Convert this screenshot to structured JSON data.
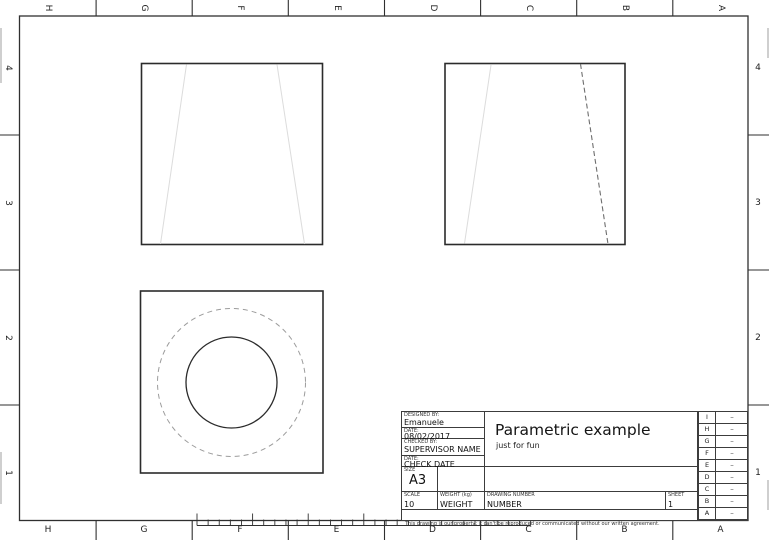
{
  "sheet": {
    "zone_letters": [
      "H",
      "G",
      "F",
      "E",
      "D",
      "C",
      "B",
      "A"
    ],
    "zone_numbers": [
      "4",
      "3",
      "2",
      "1"
    ]
  },
  "title_block": {
    "designed_by_label": "DESIGNED BY:",
    "designed_by": "Emanuele",
    "date_label": "DATE:",
    "date": "08/02/2017",
    "checked_by_label": "CHECKED BY:",
    "checked_by": "SUPERVISOR NAME",
    "check_date_label": "DATE:",
    "check_date": "CHECK DATE",
    "size_label": "SIZE",
    "size": "A3",
    "scale_label": "SCALE",
    "scale": "10",
    "weight_label": "WEIGHT (kg)",
    "weight": "WEIGHT",
    "drawing_number_label": "DRAWING NUMBER",
    "drawing_number": "NUMBER",
    "sheet_label": "SHEET",
    "sheet_number": "1",
    "title": "Parametric example",
    "subtitle": "just for fun",
    "note": "This drawing is our property; it can't be reproduced or communicated without our written agreement."
  },
  "revision_table": {
    "rows": [
      {
        "letter": "I",
        "value": "–"
      },
      {
        "letter": "H",
        "value": "–"
      },
      {
        "letter": "G",
        "value": "–"
      },
      {
        "letter": "F",
        "value": "–"
      },
      {
        "letter": "E",
        "value": "–"
      },
      {
        "letter": "D",
        "value": "–"
      },
      {
        "letter": "C",
        "value": "–"
      },
      {
        "letter": "B",
        "value": "–"
      },
      {
        "letter": "A",
        "value": "–"
      }
    ]
  },
  "colors": {
    "frame_line": "#2f2f2f",
    "hidden_line": "#6e6e6e",
    "faint_line": "#dcdcdc",
    "dashed_circle": "#9c9c9c",
    "logo_red": "#e5391d",
    "logo_blue": "#2157a4"
  }
}
